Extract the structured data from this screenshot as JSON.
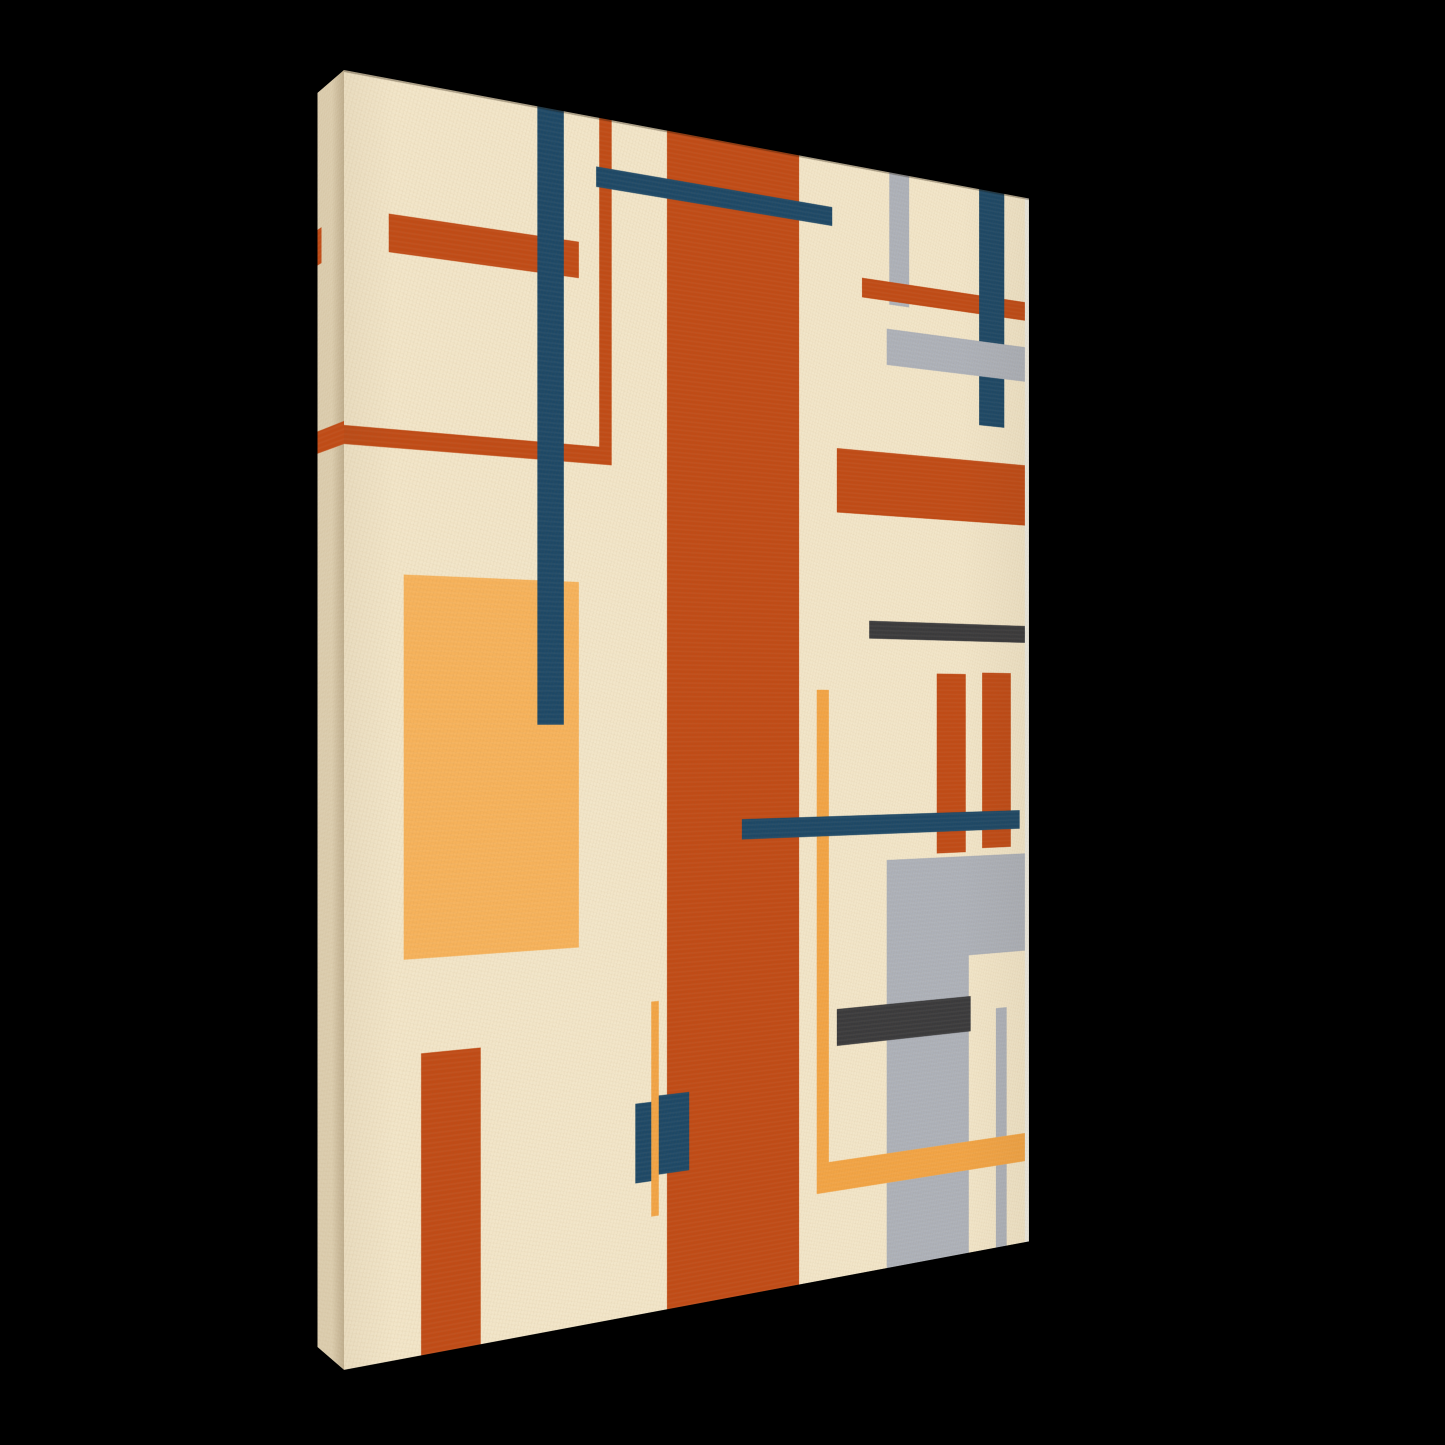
{
  "palette": {
    "background": "#000000",
    "canvas_cream": "#f2e5c8",
    "side_light": "#dccdae",
    "side_shade": "#bfae8e",
    "rust": "#c04b16",
    "amber": "#f2a445",
    "amber_light": "#f6b25b",
    "navy": "#1d4866",
    "gray": "#adb1b9",
    "charcoal": "#3a3a3c",
    "edge_highlight": "#efece2"
  },
  "canvas_print": {
    "orientation": "portrait",
    "view": "angled-right-receding",
    "artwork_style": "geometric-abstract-bauhaus",
    "front_shapes": [
      {
        "name": "rust-vertical-band",
        "color": "rust",
        "x": 41.72,
        "y": 0,
        "w": 19.63,
        "h": 100
      },
      {
        "name": "amber-rectangle",
        "color": "amber_light",
        "x": 7.15,
        "y": 38.6,
        "w": 22.38,
        "h": 30.2
      },
      {
        "name": "rust-bar-upper-left",
        "color": "rust",
        "x": 5.34,
        "y": 10.5,
        "w": 24.19,
        "h": 3.0
      },
      {
        "name": "rust-line-horizontal-left",
        "color": "rust",
        "x": 0,
        "y": 27.3,
        "w": 33.95,
        "h": 1.45
      },
      {
        "name": "rust-line-vertical-upper",
        "color": "rust",
        "x": 32.24,
        "y": 0,
        "w": 1.71,
        "h": 28.75
      },
      {
        "name": "navy-line-vertical-left",
        "color": "navy",
        "x": 23.94,
        "y": 0,
        "w": 3.57,
        "h": 50.4
      },
      {
        "name": "navy-bar-top",
        "color": "navy",
        "x": 31.83,
        "y": 4.1,
        "w": 34.7,
        "h": 1.65
      },
      {
        "name": "gray-bar-vertical-top",
        "color": "gray",
        "x": 75.75,
        "y": 0,
        "w": 3.31,
        "h": 12.05
      },
      {
        "name": "rust-bar-top-right",
        "color": "rust",
        "x": 71.33,
        "y": 10.0,
        "w": 28.67,
        "h": 1.75
      },
      {
        "name": "navy-bar-vertical-top-right",
        "color": "navy",
        "x": 91.06,
        "y": 0,
        "w": 4.43,
        "h": 22.2
      },
      {
        "name": "gray-bar-top-right",
        "color": "gray",
        "x": 75.42,
        "y": 14.3,
        "w": 24.58,
        "h": 3.3
      },
      {
        "name": "rust-bar-right",
        "color": "rust",
        "x": 67.32,
        "y": 25.6,
        "w": 32.68,
        "h": 5.8
      },
      {
        "name": "charcoal-bar-right-upper",
        "color": "charcoal",
        "x": 72.47,
        "y": 41.0,
        "w": 27.53,
        "h": 1.6
      },
      {
        "name": "rust-pillar-left",
        "color": "rust",
        "x": 83.79,
        "y": 45.7,
        "w": 5.0,
        "h": 16.7
      },
      {
        "name": "rust-pillar-right",
        "color": "rust",
        "x": 91.59,
        "y": 45.5,
        "w": 5.14,
        "h": 16.6
      },
      {
        "name": "gray-block-column",
        "color": "gray",
        "x": 75.42,
        "y": 62.8,
        "w": 13.89,
        "h": 37.2
      },
      {
        "name": "gray-block-right",
        "color": "gray",
        "x": 89.31,
        "y": 62.8,
        "w": 10.69,
        "h": 9.24
      },
      {
        "name": "gray-line-vertical-lower",
        "color": "gray",
        "x": 94.05,
        "y": 77.27,
        "w": 1.97,
        "h": 22.73
      },
      {
        "name": "charcoal-bar-right-lower",
        "color": "charcoal",
        "x": 67.32,
        "y": 75.9,
        "w": 22.33,
        "h": 3.3
      },
      {
        "name": "navy-block-left",
        "color": "navy",
        "x": 37.21,
        "y": 82.2,
        "w": 3.09,
        "h": 6.7
      },
      {
        "name": "navy-block-right",
        "color": "navy",
        "x": 40.3,
        "y": 81.8,
        "w": 4.58,
        "h": 6.7
      },
      {
        "name": "amber-line-vertical-center",
        "color": "amber",
        "x": 39.45,
        "y": 73.8,
        "w": 1.12,
        "h": 18.13
      },
      {
        "name": "rust-rectangle-bottom-left",
        "color": "rust",
        "x": 9.22,
        "y": 76.2,
        "w": 7.49,
        "h": 23.8
      },
      {
        "name": "amber-line-vertical-right",
        "color": "amber",
        "x": 64.16,
        "y": 47.3,
        "w": 1.89,
        "h": 44.9
      },
      {
        "name": "amber-bar-bottom-right",
        "color": "amber",
        "x": 64.16,
        "y": 89.5,
        "w": 35.84,
        "h": 2.7
      },
      {
        "name": "navy-bar-lower",
        "color": "navy",
        "x": 52.67,
        "y": 58.6,
        "w": 45.66,
        "h": 1.8
      },
      {
        "name": "canvas-edge-highlight",
        "color": "edge_highlight",
        "x": 99.3,
        "y": 0,
        "w": 0.7,
        "h": 100
      }
    ],
    "side_shapes": [
      {
        "name": "side-wrap-rust-strip-upper",
        "color": "rust",
        "x": 84.6,
        "y": 10.9,
        "w": 15.4,
        "h": 2.85
      },
      {
        "name": "side-wrap-rust-strip-middle",
        "color": "rust",
        "x": 0,
        "y": 27.0,
        "w": 100,
        "h": 1.8
      }
    ]
  }
}
